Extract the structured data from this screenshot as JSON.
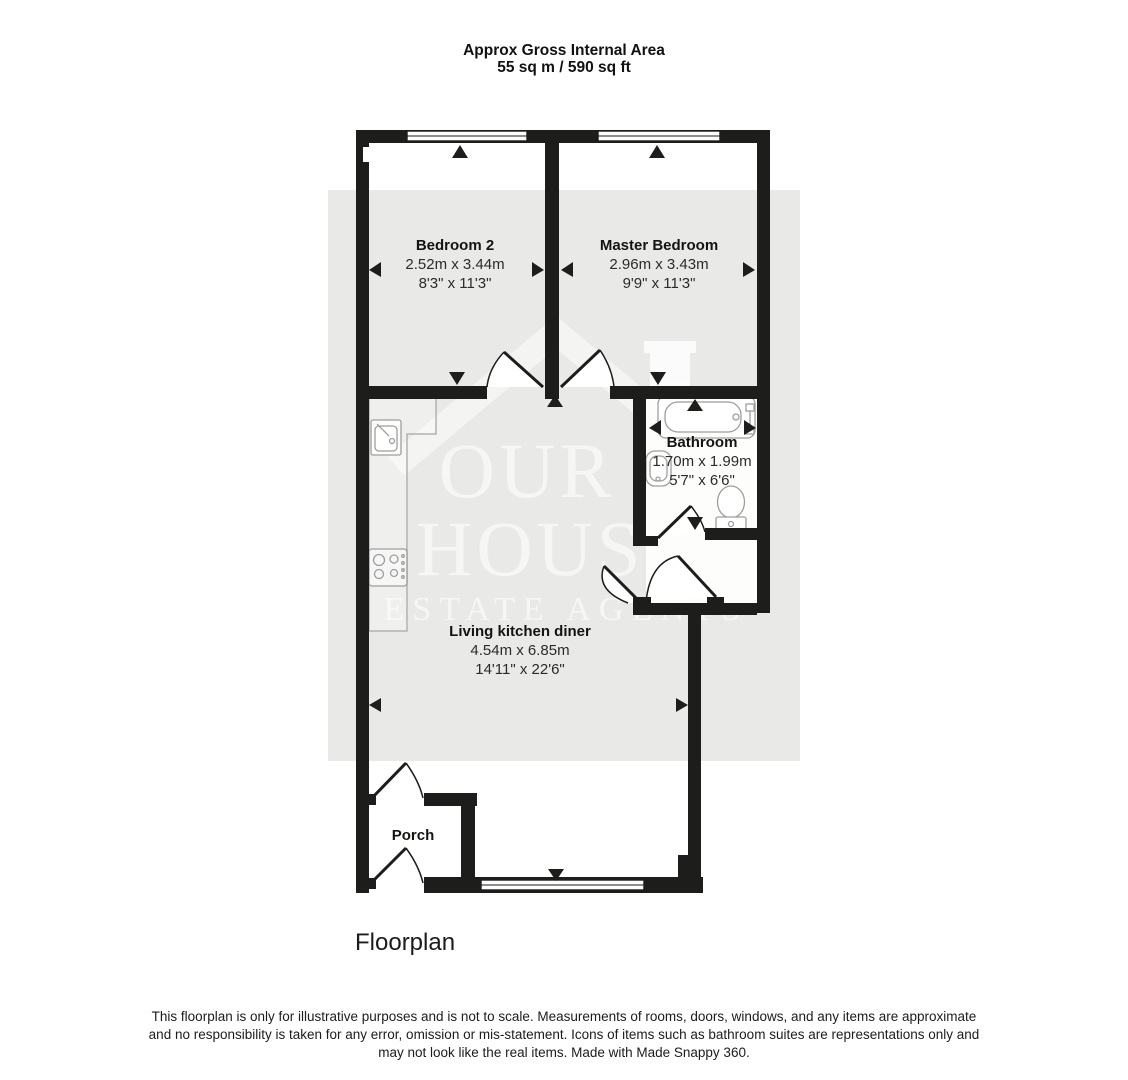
{
  "header": {
    "title_line1": "Approx Gross Internal Area",
    "title_line2": "55 sq m / 590 sq ft"
  },
  "rooms": {
    "bedroom2": {
      "name": "Bedroom 2",
      "metric": "2.52m x 3.44m",
      "imperial": "8'3\" x 11'3\""
    },
    "master": {
      "name": "Master Bedroom",
      "metric": "2.96m x 3.43m",
      "imperial": "9'9\" x 11'3\""
    },
    "bathroom": {
      "name": "Bathroom",
      "metric": "1.70m x 1.99m",
      "imperial": "5'7\" x 6'6\""
    },
    "living": {
      "name": "Living kitchen diner",
      "metric": "4.54m x 6.85m",
      "imperial": "14'11\" x 22'6\""
    },
    "porch": {
      "name": "Porch"
    }
  },
  "watermark": {
    "line1": "OUR",
    "line2": "HOUSE",
    "line3": "ESTATE AGENTS"
  },
  "caption": "Floorplan",
  "disclaimer": {
    "line1": "This floorplan is only for illustrative purposes and is not to scale. Measurements of rooms, doors, windows, and any items are approximate",
    "line2": "and no responsibility is taken for any error, omission or mis-statement. Icons of items such as bathroom suites are representations only and",
    "line3": "may not look like the real items. Made with Made Snappy 360."
  },
  "icons": [
    "bathtub-icon",
    "toilet-icon",
    "basin-icon",
    "kitchen-sink-icon",
    "hob-icon",
    "window-icon",
    "door-arc-icon",
    "direction-arrow-icon"
  ],
  "colors": {
    "wall": "#1d1d1b",
    "floor_highlight": "#e9e9e7",
    "watermark_white": "#ffffff",
    "fixture_outline": "#9e9e9c"
  }
}
